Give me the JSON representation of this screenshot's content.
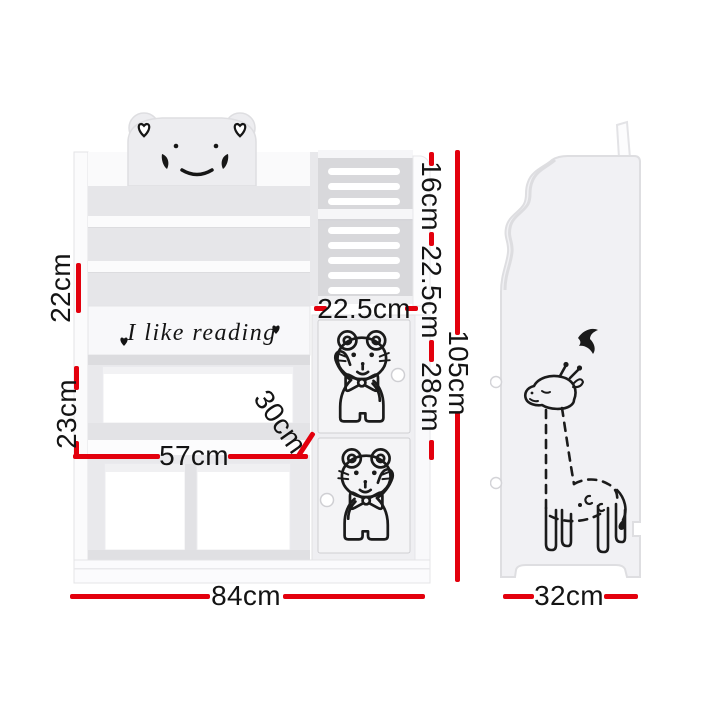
{
  "slogan": {
    "text": "I like reading"
  },
  "dimensions": {
    "tier_spacing": "22cm",
    "middle_shelf_height": "23cm",
    "inner_shelf_width": "57cm",
    "shelf_depth": "30cm",
    "overall_width": "84cm",
    "door_column_width": "22.5cm",
    "rack_upper_height": "16cm",
    "rack_lower_height": "22.5cm",
    "door_height": "28cm",
    "overall_height": "105cm",
    "overall_depth": "32cm"
  },
  "colors": {
    "dimension_line": "#e3000d",
    "label_text": "#141414",
    "artwork_line": "#1b1b1b",
    "panel_white": "#fbfbfc",
    "panel_grey": "#ededf0",
    "surface_grey": "#e6e6e9",
    "slat_back_grey": "#d8d8db",
    "background": "#ffffff"
  },
  "icons": {
    "bear_face": "grumpy-bear-face-icon",
    "ear_hearts": "heart-icon",
    "slogan_hearts": "heart-icon",
    "door_bears": "waving-teddy-bear-icon",
    "side_giraffe": "giraffe-icon",
    "side_bird": "flying-bird-icon"
  }
}
